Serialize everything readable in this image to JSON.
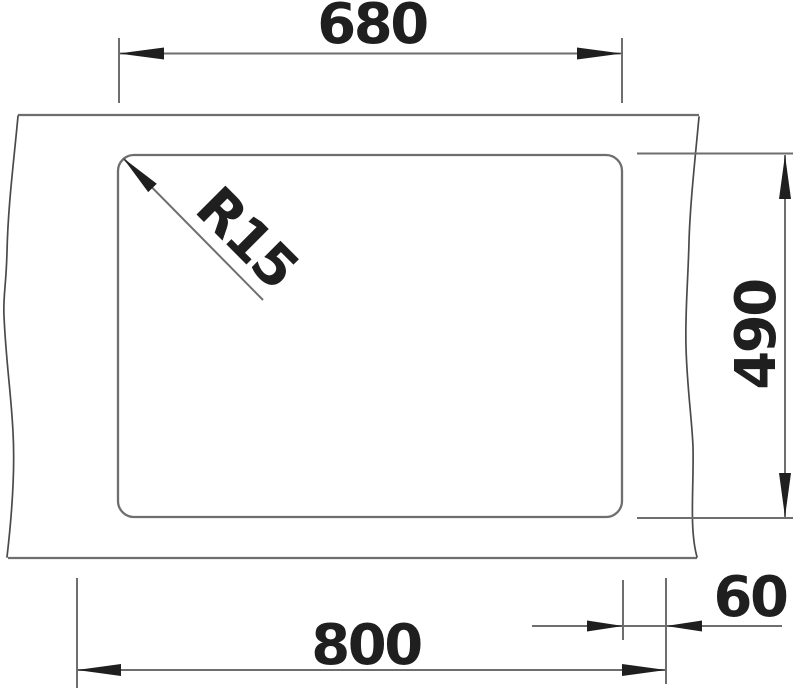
{
  "drawing_type": "sink-cutout-dimension-diagram",
  "dimensions": {
    "inner_width": "680",
    "inner_height": "490",
    "outer_width": "800",
    "edge_offset": "60",
    "corner_radius": "R15"
  },
  "colors": {
    "line": "#6e6e6e",
    "break_line": "#4a4a4a",
    "annotation": "#1f1f1f",
    "background": "#ffffff"
  }
}
